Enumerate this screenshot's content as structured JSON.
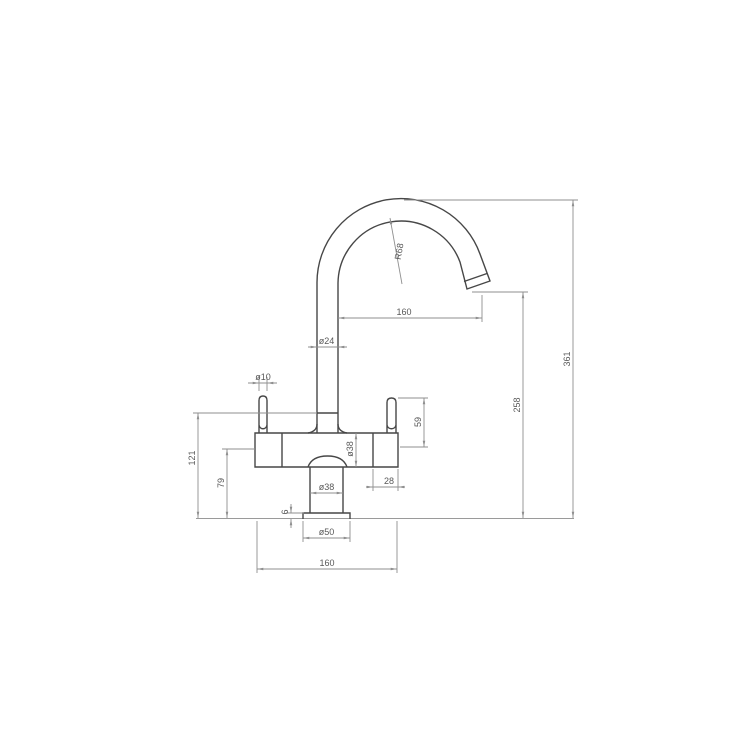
{
  "drawing": {
    "colors": {
      "outline": "#474747",
      "dimension_lines": "#8f8f8f",
      "label_text": "#585858",
      "background": "#ffffff"
    },
    "dims": {
      "lever_diameter": "ø10",
      "riser_diameter": "ø24",
      "spout_radius": "R68",
      "spout_reach": "160",
      "overall_height": "361",
      "outlet_height": "258",
      "riser_joint_height": "121",
      "body_centre_height": "79",
      "handle_height": "59",
      "body_diameter": "ø38",
      "handle_body_width": "28",
      "stem_diameter": "ø38",
      "base_plate_thickness": "6",
      "base_plate_diameter": "ø50",
      "overall_base_width": "160"
    }
  }
}
